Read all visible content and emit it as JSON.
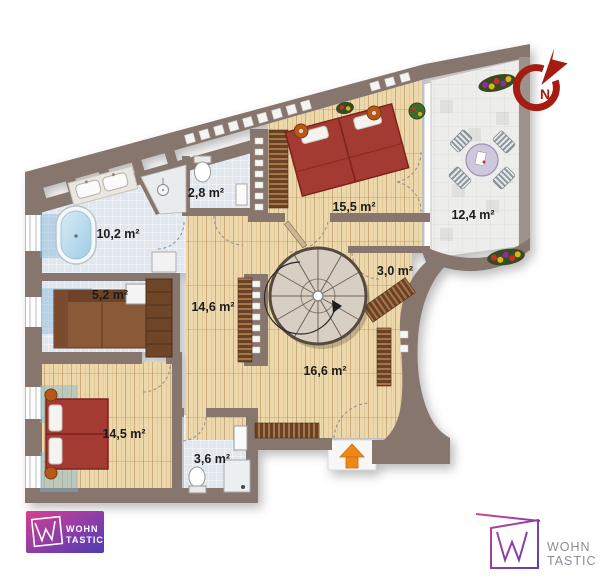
{
  "floorplan": {
    "rooms": [
      {
        "id": "bathroom-large",
        "label": "10,2 m²"
      },
      {
        "id": "wc",
        "label": "2,8 m²"
      },
      {
        "id": "storage",
        "label": "5,2 m²"
      },
      {
        "id": "hallway",
        "label": "14,6 m²"
      },
      {
        "id": "bedroom-large",
        "label": "15,5 m²"
      },
      {
        "id": "terrace",
        "label": "12,4 m²"
      },
      {
        "id": "closet",
        "label": "3,0 m²"
      },
      {
        "id": "living-room",
        "label": "16,6 m²"
      },
      {
        "id": "bedroom-small",
        "label": "14,5 m²"
      },
      {
        "id": "bathroom-small",
        "label": "3,6 m²"
      }
    ],
    "compass": {
      "north_label": "N"
    },
    "branding": {
      "logo_left": {
        "line1": "WOHN",
        "line2": "TASTIC"
      },
      "logo_right": {
        "line1": "WOHN",
        "line2": "TASTIC"
      }
    },
    "colors": {
      "wall": "#87766e",
      "wood_floor": "#ecd8ab",
      "tile_floor": "#e0e7ee",
      "terrace_floor": "#ededeb",
      "bed_red": "#a33a30",
      "furniture_brown": "#8a5a38",
      "compass_red": "#a41d10",
      "entrance_arrow_orange": "#ef8714",
      "logo_pink": "#d4418f",
      "logo_purple": "#5b3fb0"
    }
  }
}
